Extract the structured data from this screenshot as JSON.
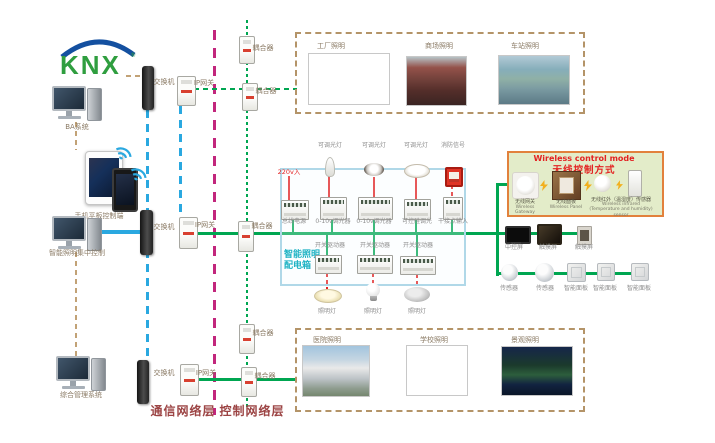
{
  "palette": {
    "knx_bus_green": "#00a651",
    "ethernet_blue": "#2aa8e0",
    "control_layer_magenta": "#c2267c",
    "management_tan": "#c2a276",
    "power_red": "#e32222",
    "cabinet_border_blue": "#b0d8e8",
    "cabinet_title_cyan": "#1fb3c4",
    "wireless_box_bg": "#e3ecc9",
    "wireless_box_border": "#e2813c",
    "layer_label_color": "#9c4444"
  },
  "logo": {
    "text": "KNX",
    "reg": "®"
  },
  "left": {
    "computer1_label": "BA系统",
    "tablet_label": "手机平板控制端",
    "computer2_label": "智能照明集中控制",
    "computer3_label": "综合管理系统"
  },
  "network": {
    "switch_label": "交换机",
    "gateway_label": "IP网关",
    "coupler_label": "耦合器",
    "comm_layer_label": "通信网络层",
    "ctrl_layer_label": "控制网络层"
  },
  "photos_top": {
    "items": [
      {
        "label": "工厂照明"
      },
      {
        "label": "商场照明"
      },
      {
        "label": "车站照明"
      }
    ]
  },
  "photos_bottom": {
    "items": [
      {
        "label": "医院照明"
      },
      {
        "label": "学校照明"
      },
      {
        "label": "景观照明"
      }
    ]
  },
  "cabinet": {
    "title_line1": "智能照明",
    "title_line2": "配电箱",
    "power_input_label": "220v入",
    "dimmable_light_label": "可调光灯",
    "fire_signal_label": "消防信号",
    "devices": [
      "总线电源",
      "0-10v调光器",
      "0-10v调光器",
      "可控硅调光",
      "干接点输入"
    ],
    "driver_label": "开关驱动器",
    "lamp_label": "照明灯"
  },
  "wireless": {
    "title_en": "Wireless control mode",
    "title_zh": "无线控制方式",
    "devices": [
      {
        "zh": "无线网关",
        "en": "Wireless Gateway"
      },
      {
        "zh": "无线面板",
        "en": "Wireless Panel"
      },
      {
        "zh": "无线红外（温湿度）传感器",
        "en": "Wireless infrared (Temperature and humidity) sensor"
      }
    ]
  },
  "right": {
    "central_screen_label": "中控屏",
    "touch_screen_label": "触摸屏",
    "sensor_label": "传感器",
    "smart_panel_label": "智能面板"
  }
}
